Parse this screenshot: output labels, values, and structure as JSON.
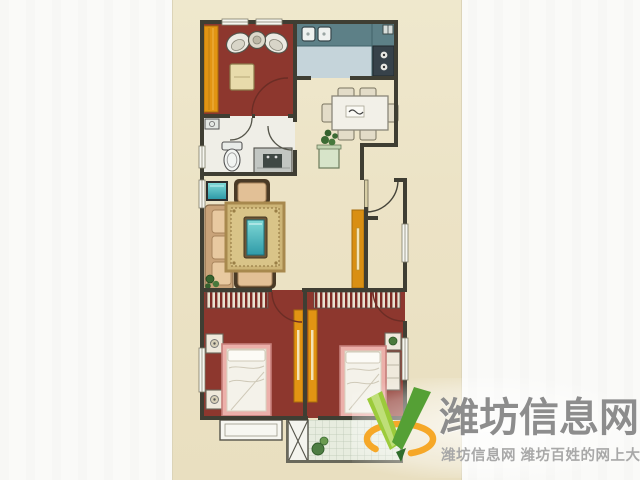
{
  "watermark": {
    "logo": "weifang-v-leaf-logo",
    "title": "潍坊信息网",
    "subtitle": "潍坊信息网 潍坊百姓的网上大集",
    "colors": {
      "title": "#8d8d8d",
      "subtitle": "#a8a8a8",
      "logo_green_light": "#9ccb3b",
      "logo_green_dark": "#55a035",
      "logo_orange": "#f5a31d"
    }
  },
  "floorplan": {
    "description": "top-down rendered floor plan of a three-bedroom apartment, no text labels",
    "rooms": [
      {
        "name": "study-bedroom-top-left",
        "floor": "dark-red",
        "furniture": [
          "wardrobe-strip",
          "two-tub-chairs",
          "round-table",
          "nightstand"
        ]
      },
      {
        "name": "kitchen-top-right",
        "floor": "light-blue",
        "furniture": [
          "l-counter",
          "double-sink",
          "stove-two-burners"
        ]
      },
      {
        "name": "dining-area",
        "floor": "beige",
        "furniture": [
          "dining-table",
          "six-chairs",
          "potted-plant"
        ]
      },
      {
        "name": "bathroom",
        "floor": "white",
        "furniture": [
          "toilet",
          "vanity-sink",
          "small-basin"
        ]
      },
      {
        "name": "living-room",
        "floor": "beige",
        "furniture": [
          "tv",
          "sofa",
          "two-armchairs",
          "ornate-rug",
          "teal-coffee-table",
          "plant",
          "hall-cabinet"
        ]
      },
      {
        "name": "entry-foyer",
        "floor": "beige",
        "furniture": [
          "entry-door-arc"
        ]
      },
      {
        "name": "bedroom-bottom-left",
        "floor": "dark-red",
        "furniture": [
          "bed",
          "two-nightstands",
          "curtain-strip",
          "wardrobe-strip"
        ]
      },
      {
        "name": "bedroom-bottom-right",
        "floor": "dark-red",
        "furniture": [
          "bed",
          "nightstand",
          "dresser",
          "curtain-strip",
          "wardrobe-strip"
        ]
      },
      {
        "name": "balcony",
        "floor": "tiled",
        "furniture": [
          "flue-x-box",
          "potted-plant"
        ]
      },
      {
        "name": "bay-window",
        "floor": "white",
        "furniture": []
      }
    ],
    "colors": {
      "paper": "#ece3c6",
      "wall": "#3f3e33",
      "bedroom_floor": "#8d372e",
      "wardrobe_orange": "#e29413",
      "kitchen_floor": "#c5d4da",
      "counter_teal": "#5d8087",
      "stove": "#37424a",
      "bath_floor": "#efeee7",
      "rug": "#d0b977",
      "sofa": "#d9b58d",
      "coffee_table_teal": "#49b8c0",
      "bed_frame_pink": "#ecb0aa",
      "bed_linen": "#f4f2ea",
      "balcony_tile": "#e7ecdf",
      "margin_white": "#fafaf8"
    }
  }
}
